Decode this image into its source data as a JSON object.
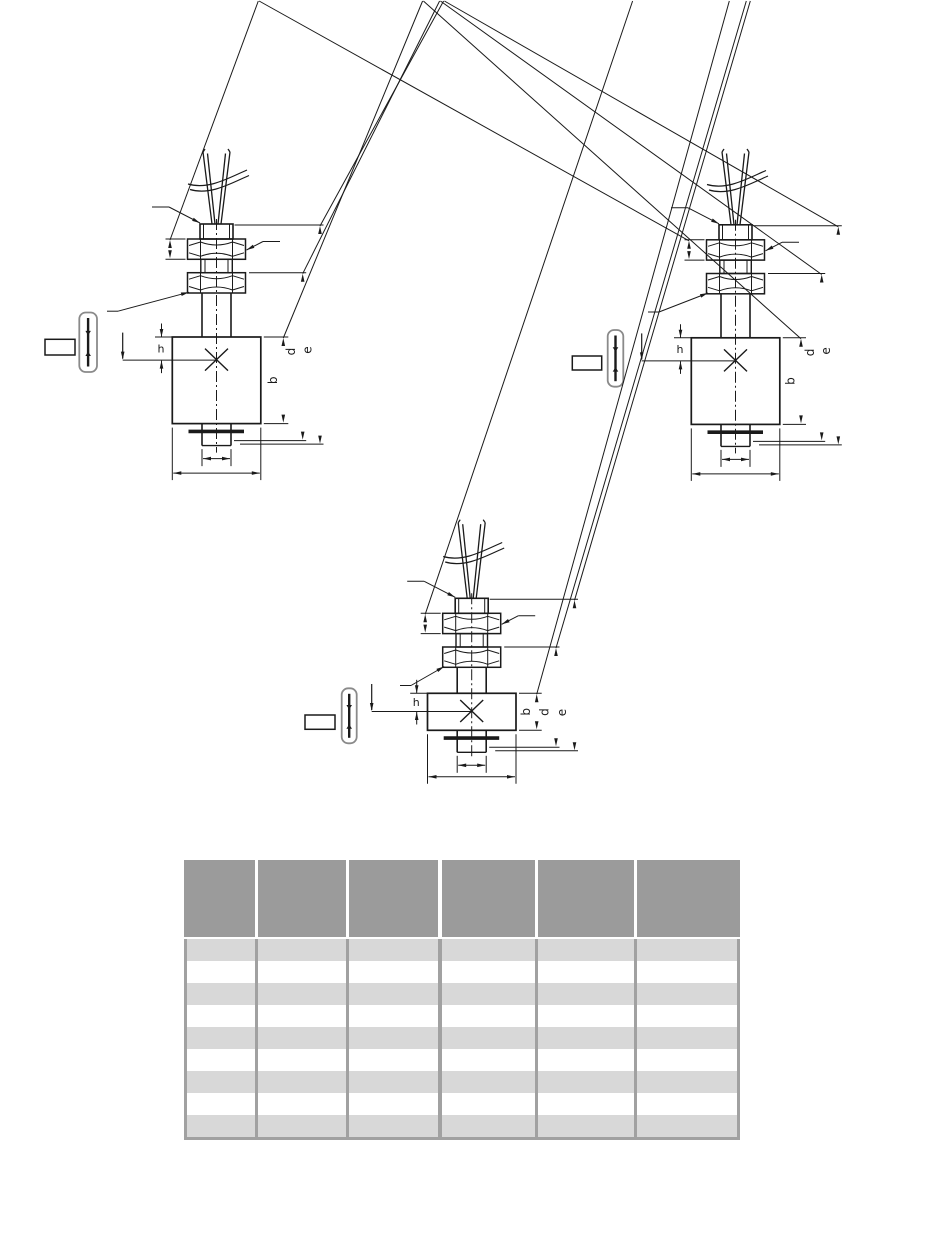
{
  "page": {
    "background_color": "#ffffff",
    "content_type": "level-switch dimensional drawings with empty dimensions table"
  },
  "drawings": {
    "count": 3,
    "dimension_labels": {
      "h": "h",
      "b": "b",
      "d": "d",
      "e": "e"
    },
    "instances": [
      {
        "position": "top-left",
        "variant": "tall-float"
      },
      {
        "position": "top-right",
        "variant": "tall-float"
      },
      {
        "position": "center",
        "variant": "short-float"
      }
    ],
    "symbols": [
      "reed-switch-capsule",
      "terminal-box",
      "liquid-level-arrow",
      "switch-point-cross",
      "cable-break-mark"
    ],
    "line_color": "#1a1a1a"
  },
  "table": {
    "header_cells": [
      "",
      "",
      "",
      "",
      "",
      ""
    ],
    "rows": [
      [
        "",
        "",
        "",
        "",
        "",
        ""
      ],
      [
        "",
        "",
        "",
        "",
        "",
        ""
      ],
      [
        "",
        "",
        "",
        "",
        "",
        ""
      ],
      [
        "",
        "",
        "",
        "",
        "",
        ""
      ],
      [
        "",
        "",
        "",
        "",
        "",
        ""
      ],
      [
        "",
        "",
        "",
        "",
        "",
        ""
      ],
      [
        "",
        "",
        "",
        "",
        "",
        ""
      ],
      [
        "",
        "",
        "",
        "",
        "",
        ""
      ],
      [
        "",
        "",
        "",
        "",
        "",
        ""
      ]
    ],
    "colors": {
      "header_bg": "#9b9b9b",
      "alt_row_bg": "#d8d8d8",
      "row_bg": "#ffffff",
      "grid": "#a1a1a1"
    }
  }
}
